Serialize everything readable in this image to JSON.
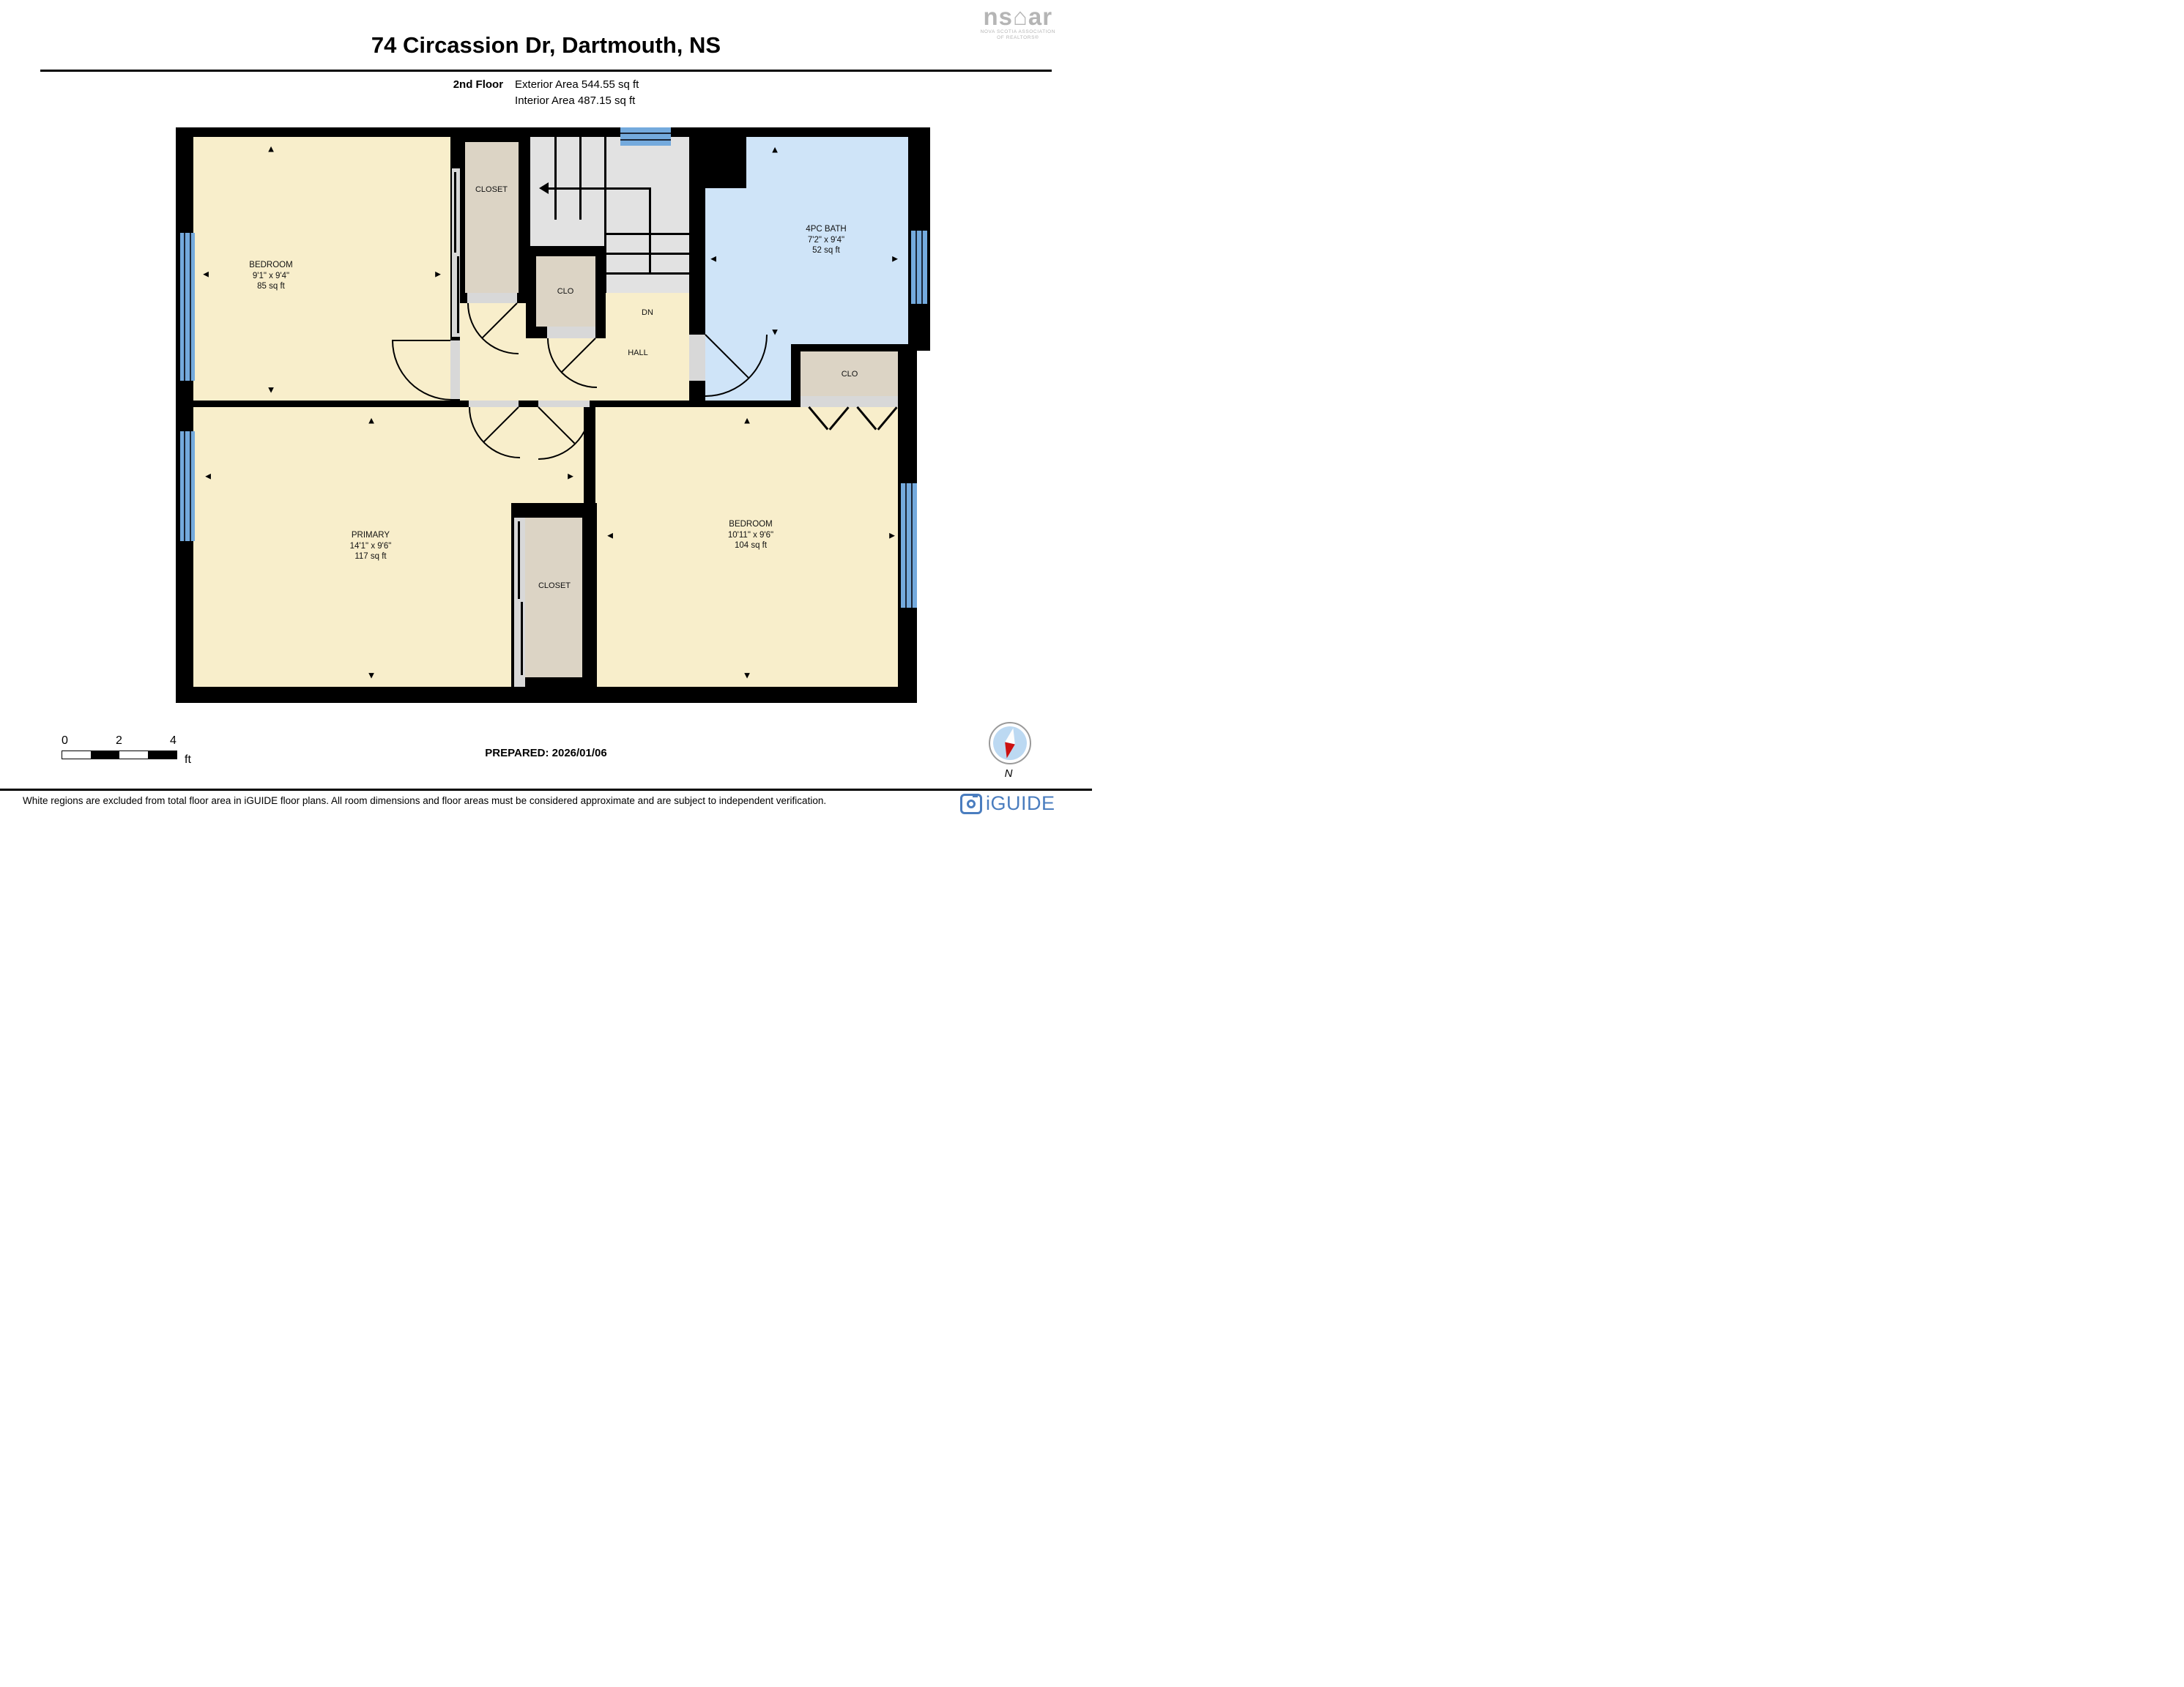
{
  "header": {
    "title": "74 Circassion Dr, Dartmouth, NS",
    "floor_label": "2nd Floor",
    "exterior_area": "Exterior Area 544.55 sq ft",
    "interior_area": "Interior Area 487.15 sq ft"
  },
  "nsar": {
    "wordmark": "ns⌂ar",
    "line1": "NOVA SCOTIA ASSOCIATION",
    "line2": "OF REALTORS®"
  },
  "floor_plan": {
    "rooms": {
      "bedroom_tl": {
        "name": "BEDROOM",
        "dims": "9'1\" x 9'4\"",
        "area": "85 sq ft"
      },
      "bath": {
        "name": "4PC BATH",
        "dims": "7'2\" x 9'4\"",
        "area": "52 sq ft"
      },
      "primary": {
        "name": "PRIMARY",
        "dims": "14'1\" x 9'6\"",
        "area": "117 sq ft"
      },
      "bedroom_br": {
        "name": "BEDROOM",
        "dims": "10'11\" x 9'6\"",
        "area": "104 sq ft"
      },
      "closet_top": {
        "label": "CLOSET"
      },
      "clo_mid": {
        "label": "CLO"
      },
      "clo_right": {
        "label": "CLO"
      },
      "closet_bottom": {
        "label": "CLOSET"
      },
      "hall": {
        "label": "HALL"
      },
      "stairs": {
        "label": "DN"
      }
    },
    "glyphs": {
      "up": "▲",
      "down": "▼",
      "left": "◄",
      "right": "►"
    }
  },
  "scale_bar": {
    "tick0": "0",
    "tick2": "2",
    "tick4": "4",
    "unit": "ft"
  },
  "prepared_label": "PREPARED: 2026/01/06",
  "compass_label": "N",
  "disclaimer": "White regions are excluded from total floor area in iGUIDE floor plans. All room dimensions and floor areas must be considered approximate and are subject to independent verification.",
  "iguide_label": "iGUIDE",
  "colors": {
    "room_fill": "#f8eecb",
    "closet_fill": "#dcd4c5",
    "bath_fill": "#cfe4f8",
    "stairs_fill": "#e2e2e2",
    "door_gap": "#d8d8d8",
    "window_blue": "#74aadd",
    "wall": "#000000",
    "iguide_blue": "#4a7dbf",
    "compass_red": "#cc1111",
    "nsar_gray": "#b5b5b5"
  }
}
